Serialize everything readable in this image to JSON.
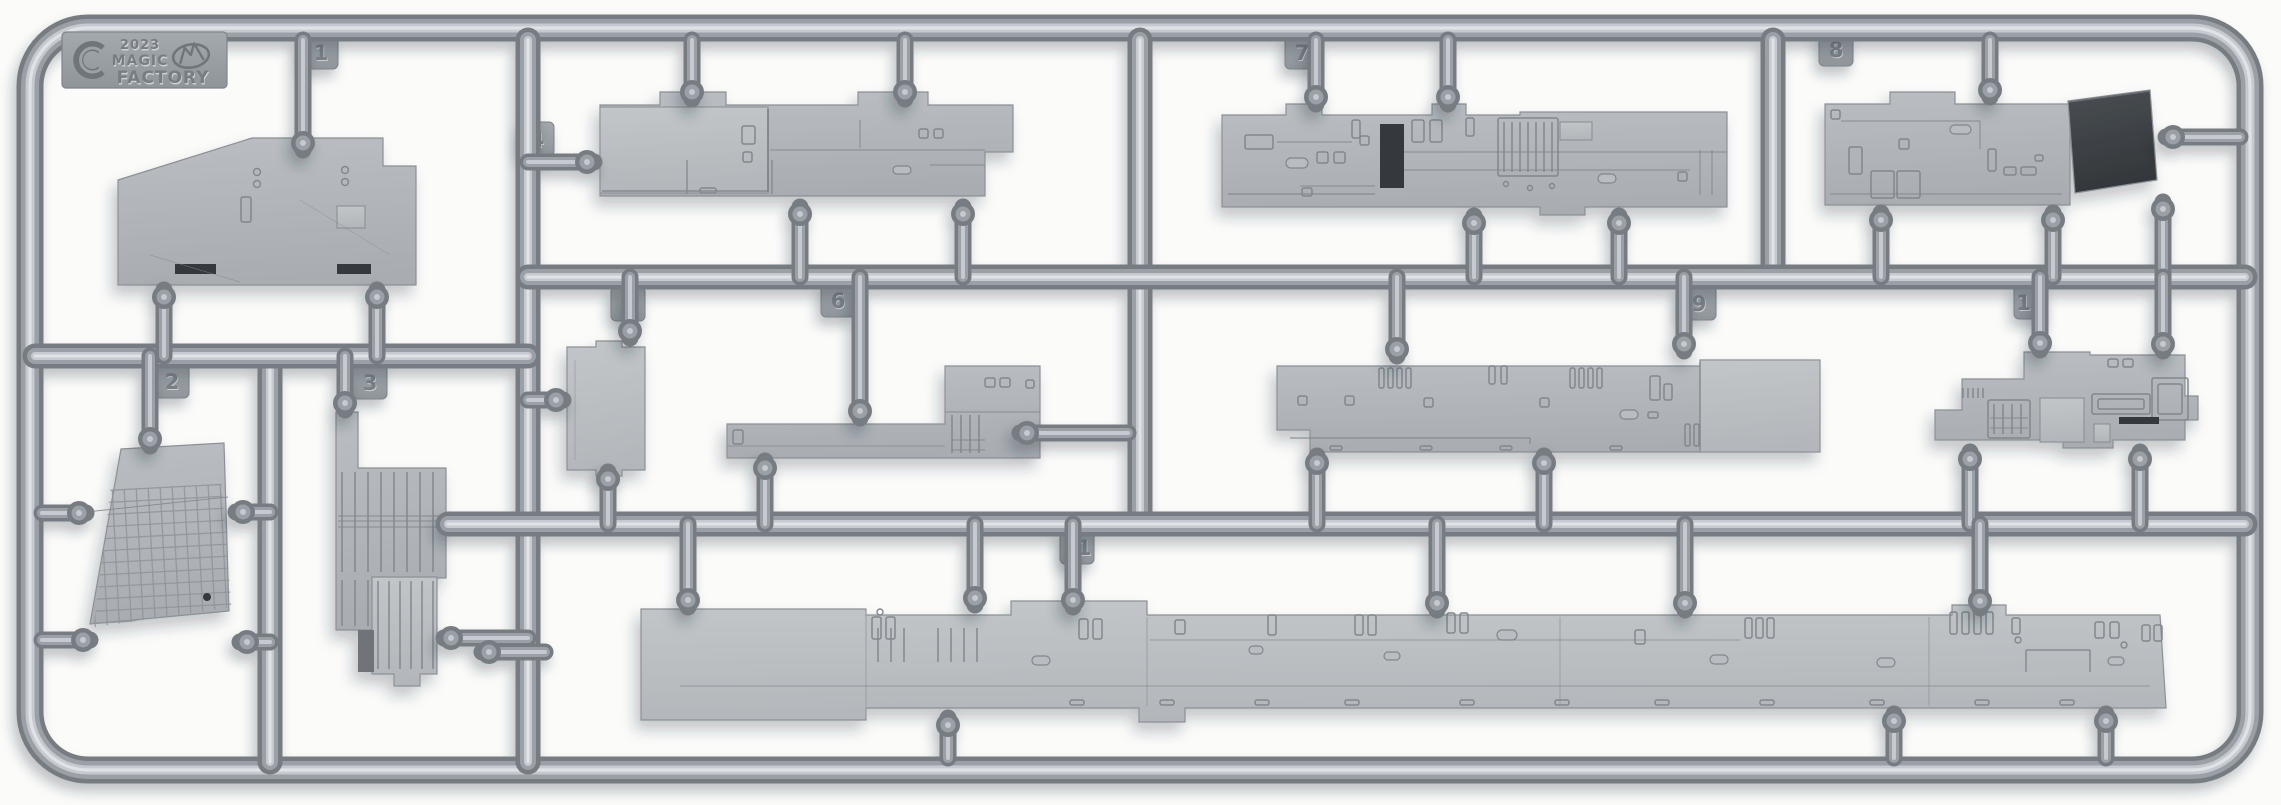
{
  "photo_subject": "injection-molded plastic model kit sprue on white background",
  "branding": {
    "sprue_letter": "C",
    "year": "2023",
    "name_line1": "MAGIC",
    "name_line2": "FACTORY",
    "logo_icon": "mountain-in-oval-logo",
    "letter_icon": "sprue-letter-c-ring"
  },
  "tags": [
    {
      "label": "1"
    },
    {
      "label": "2"
    },
    {
      "label": "3"
    },
    {
      "label": "4"
    },
    {
      "label": "5"
    },
    {
      "label": "6"
    },
    {
      "label": "7"
    },
    {
      "label": "8"
    },
    {
      "label": "9"
    },
    {
      "label": "10"
    },
    {
      "label": "11"
    }
  ],
  "palette": {
    "background": "#fbfbfa",
    "runner_edge": "#767c82",
    "runner_mid": "#9aa0a6",
    "runner_light": "#c6cad0",
    "runner_spec": "#e0e3e6",
    "part_face_top": "#babec2",
    "part_face_bottom": "#a9adb2",
    "part_face_light": "#c2c6c9",
    "part_edge": "#8b9096",
    "detail_engraved": "#82878d",
    "slot_dark": "#34383c",
    "flap_dark_top": "#4a4e53",
    "flap_dark_bottom": "#33373b",
    "tag_face": "#9aa0a5",
    "tag_number": "#7c8187",
    "emboss_light": "#cdd1d5",
    "emboss_dark": "#787d83",
    "shadow": "rgba(40,45,55,0.26)"
  }
}
